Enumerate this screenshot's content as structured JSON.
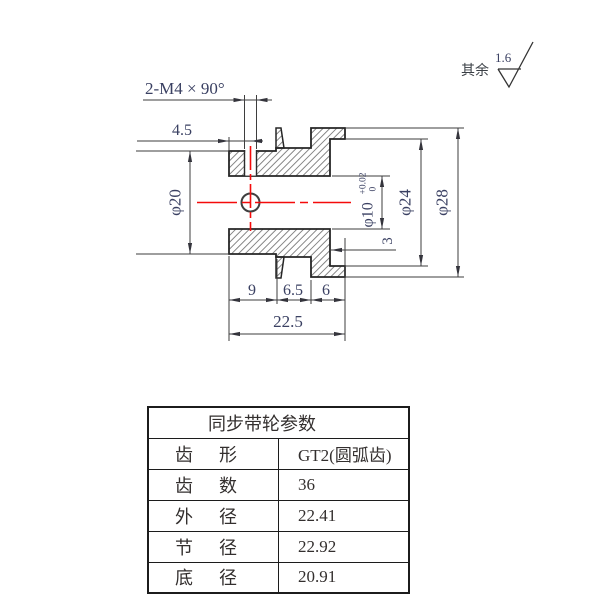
{
  "drawing": {
    "dims": {
      "m4": "2-M4 × 90°",
      "d45": "4.5",
      "phi20": "φ20",
      "phi10": "φ10",
      "phi10_tol_upper": "+0.02",
      "phi10_tol_lower": "0",
      "phi24": "φ24",
      "phi28": "φ28",
      "depth3": "3",
      "w9": "9",
      "w65": "6.5",
      "w6": "6",
      "w225": "22.5"
    },
    "surface_note": {
      "prefix": "其余",
      "roughness": "1.6"
    },
    "colors": {
      "centerline_red": "#f40b0b",
      "outline": "#262626",
      "dim_line": "#3e3e3e",
      "dim_text": "#3a4062"
    }
  },
  "table": {
    "title": "同步带轮参数",
    "rows": [
      {
        "label": "齿　形",
        "value": "GT2(圆弧齿)"
      },
      {
        "label": "齿　数",
        "value": "36"
      },
      {
        "label": "外　径",
        "value": "22.41"
      },
      {
        "label": "节　径",
        "value": "22.92"
      },
      {
        "label": "底　径",
        "value": "20.91"
      }
    ]
  }
}
